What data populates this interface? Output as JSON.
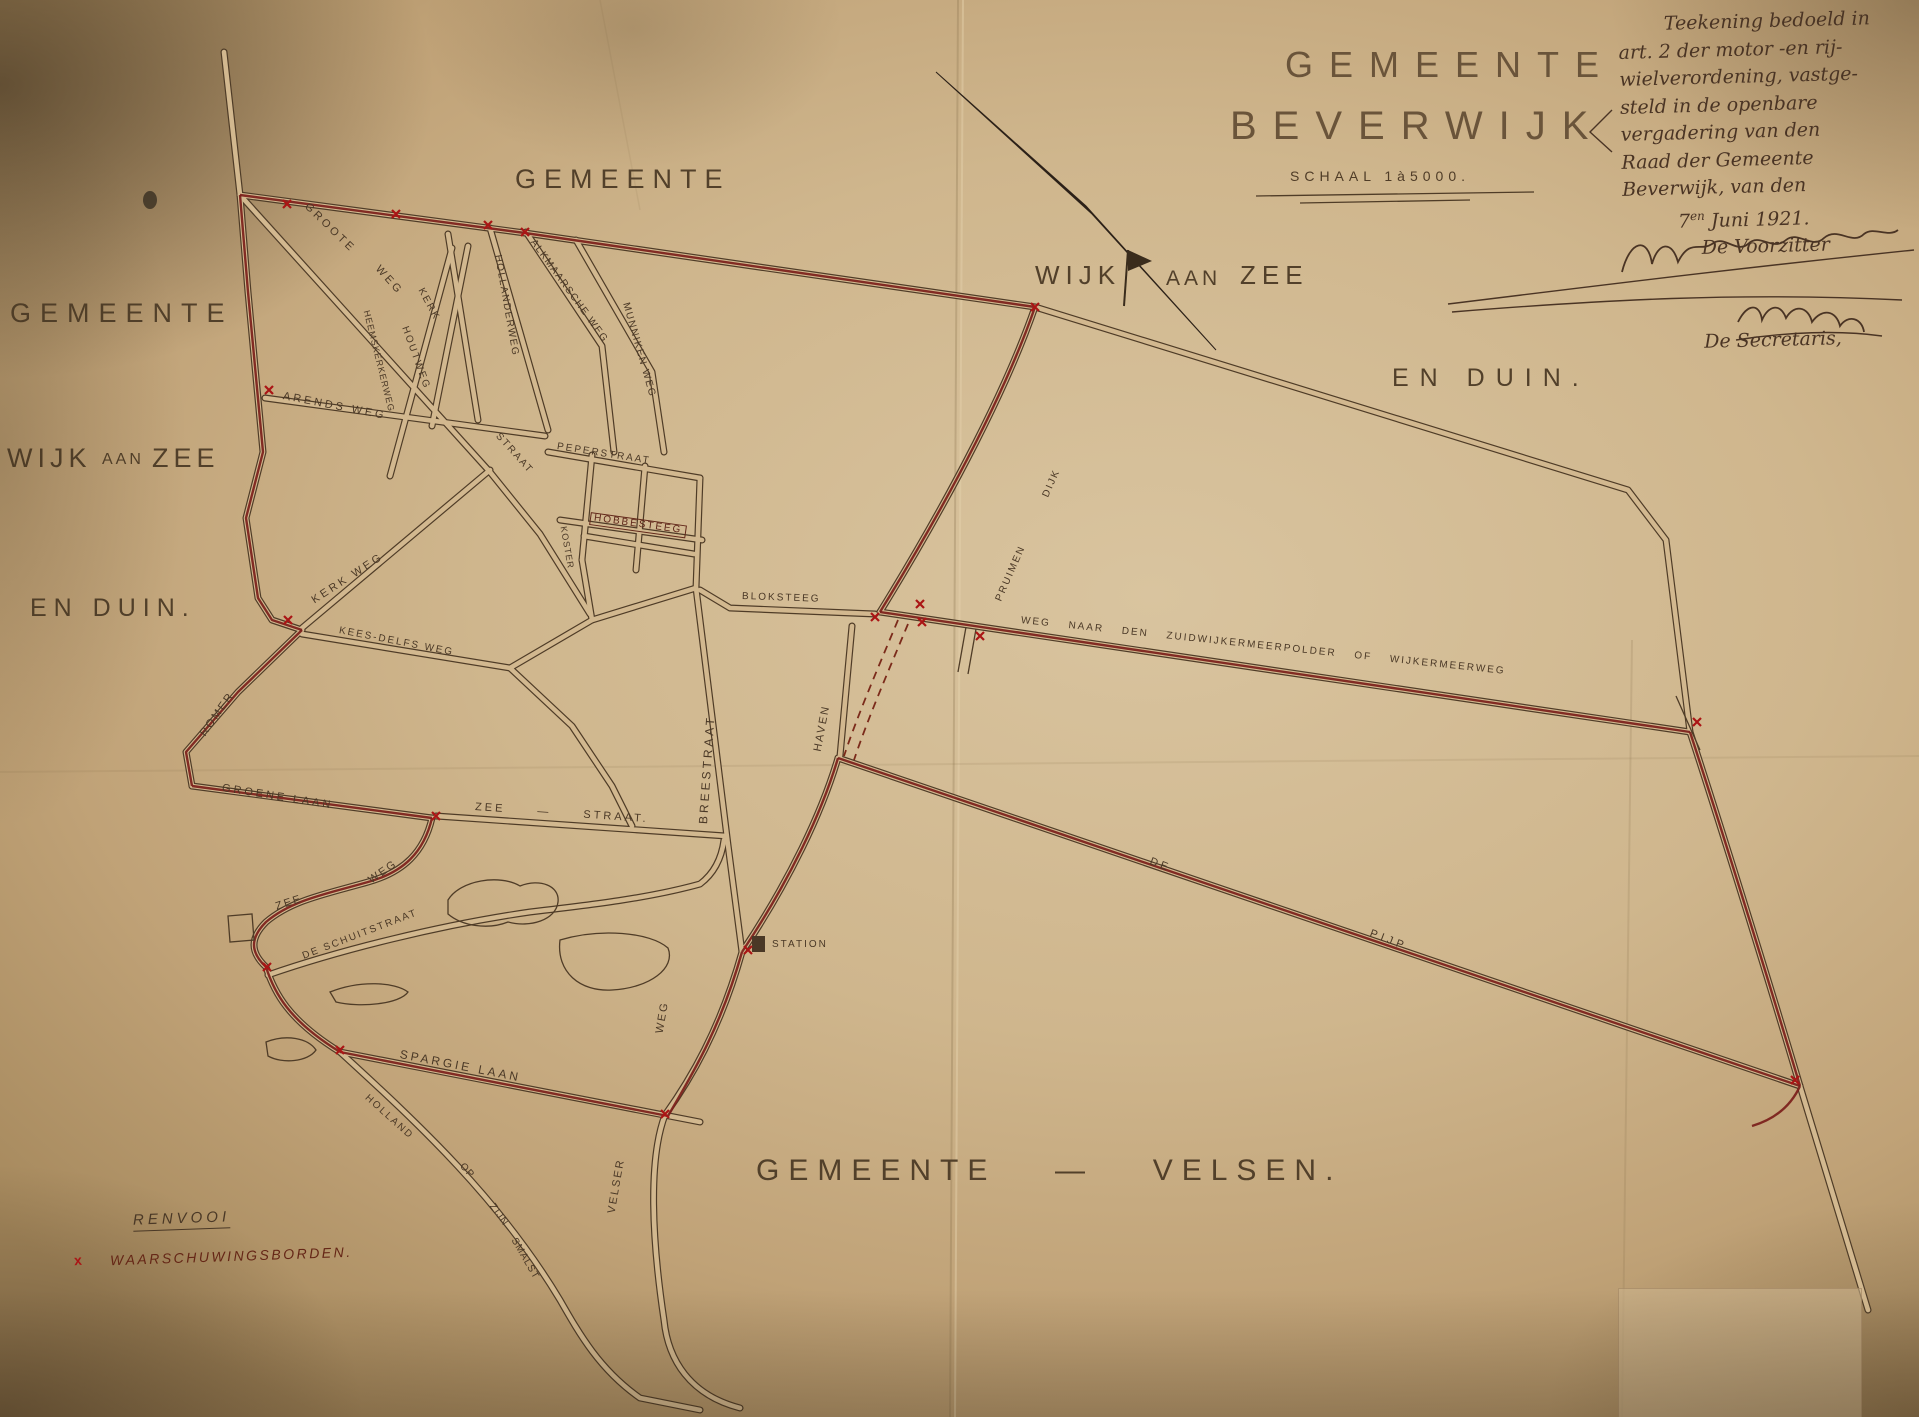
{
  "title_block": {
    "gemeente": "GEMEENTE",
    "beverwijk": "BEVERWIJK",
    "schaal": "SCHAAL 1à5000."
  },
  "note": {
    "lines": [
      "Teekening bedoeld in",
      "art. 2 der motor -en rij-",
      "wielverordening, vastge-",
      "steld in de openbare",
      "vergadering van den",
      "Raad der Gemeente",
      "Beverwijk, van den"
    ],
    "date_prefix": "7",
    "date_sup": "en",
    "date_rest": " Juni 1921.",
    "voorzitter": "De Voorzitter",
    "secretaris": "De Secretaris,"
  },
  "legend": {
    "title": "RENVOOI",
    "mark": "x",
    "label": "WAARSCHUWINGSBORDEN."
  },
  "colors": {
    "paper": "#d2b88f",
    "ink": "#4a3826",
    "boundary_red": "#7b1e1a",
    "mark_red": "#aa1515"
  },
  "labels": [
    {
      "id": "territory-gemeente-top",
      "t": "GEMEENTE",
      "x": 515,
      "y": 166,
      "s": 27,
      "r": 0,
      "ls": 8,
      "c": "#52402a"
    },
    {
      "id": "territory-gemeente-left",
      "t": "GEMEENTE",
      "x": 10,
      "y": 300,
      "s": 27,
      "r": 0,
      "ls": 9,
      "c": "#52402a"
    },
    {
      "id": "territory-wijk-left",
      "t": "WIJK",
      "x": 7,
      "y": 445,
      "s": 27,
      "r": 0,
      "ls": 5,
      "c": "#52402a"
    },
    {
      "id": "territory-aan-left",
      "t": "AAN",
      "x": 102,
      "y": 452,
      "s": 16,
      "r": 0,
      "ls": 3,
      "c": "#52402a"
    },
    {
      "id": "territory-zee-left",
      "t": "ZEE",
      "x": 152,
      "y": 445,
      "s": 27,
      "r": 0,
      "ls": 5,
      "c": "#52402a"
    },
    {
      "id": "territory-en-duin-left",
      "t": "EN DUIN.",
      "x": 30,
      "y": 596,
      "s": 25,
      "r": 0,
      "ls": 7,
      "c": "#52402a"
    },
    {
      "id": "territory-wijk-center",
      "t": "WIJK",
      "x": 1035,
      "y": 262,
      "s": 26,
      "r": 0,
      "ls": 6,
      "c": "#52402a"
    },
    {
      "id": "territory-aan-center",
      "t": "AAN",
      "x": 1166,
      "y": 268,
      "s": 21,
      "r": 0,
      "ls": 4,
      "c": "#52402a"
    },
    {
      "id": "territory-zee-center",
      "t": "ZEE",
      "x": 1240,
      "y": 262,
      "s": 26,
      "r": 0,
      "ls": 6,
      "c": "#52402a"
    },
    {
      "id": "territory-en-duin-right",
      "t": "EN DUIN.",
      "x": 1392,
      "y": 366,
      "s": 25,
      "r": 0,
      "ls": 11,
      "c": "#52402a"
    },
    {
      "id": "territory-gemeente-velsen",
      "t": "GEMEENTE  —  VELSEN.",
      "x": 756,
      "y": 1156,
      "s": 30,
      "r": 0,
      "ls": 9,
      "ws": 12,
      "c": "#52402a"
    },
    {
      "id": "street-groote",
      "t": "GROOTE",
      "x": 306,
      "y": 200,
      "s": 11,
      "r": 44,
      "ls": 3
    },
    {
      "id": "street-groote-weg",
      "t": "WEG",
      "x": 377,
      "y": 262,
      "s": 11,
      "r": 48,
      "ls": 3
    },
    {
      "id": "street-kerk",
      "t": "KERK",
      "x": 420,
      "y": 284,
      "s": 10,
      "r": 62,
      "ls": 2
    },
    {
      "id": "street-houtweg",
      "t": "HOUTWEG",
      "x": 404,
      "y": 322,
      "s": 10,
      "r": 70,
      "ls": 2
    },
    {
      "id": "street-heemskerkerweg",
      "t": "HEEMSKERKERWEG",
      "x": 366,
      "y": 306,
      "s": 9,
      "r": 76,
      "ls": 1
    },
    {
      "id": "street-hollanderweg",
      "t": "HOLLANDERWEG",
      "x": 497,
      "y": 250,
      "s": 10,
      "r": 80,
      "ls": 1.5
    },
    {
      "id": "street-alkmaarsche-weg",
      "t": "ALKMAARSCHE WEG",
      "x": 532,
      "y": 236,
      "s": 10,
      "r": 54,
      "ls": 1.5
    },
    {
      "id": "street-munniken-weg",
      "t": "MUNNIKEN WEG",
      "x": 625,
      "y": 298,
      "s": 10,
      "r": 74,
      "ls": 1.5
    },
    {
      "id": "street-arends-weg",
      "t": "ARENDS WEG",
      "x": 283,
      "y": 391,
      "s": 11,
      "r": 11,
      "ls": 3
    },
    {
      "id": "street-peperstraat",
      "t": "PEPERSTRAAT",
      "x": 557,
      "y": 442,
      "s": 10,
      "r": 9,
      "ls": 2
    },
    {
      "id": "street-hobbesteeg",
      "t": "HOBBESTEEG",
      "x": 590,
      "y": 512,
      "s": 10,
      "r": 8,
      "ls": 2,
      "c": "#5d2418",
      "box": true
    },
    {
      "id": "street-koster",
      "t": "KOSTER",
      "x": 563,
      "y": 522,
      "s": 9,
      "r": 80,
      "ls": 1
    },
    {
      "id": "street-straat",
      "t": "STRAAT",
      "x": 497,
      "y": 430,
      "s": 10,
      "r": 48,
      "ls": 2
    },
    {
      "id": "street-kerk-weg",
      "t": "KERK WEG",
      "x": 313,
      "y": 596,
      "s": 11,
      "r": -33,
      "ls": 3
    },
    {
      "id": "street-kees-delfs-weg",
      "t": "KEES-DELFS WEG",
      "x": 339,
      "y": 626,
      "s": 10,
      "r": 11,
      "ls": 2
    },
    {
      "id": "street-romer",
      "t": "ROMER",
      "x": 203,
      "y": 730,
      "s": 11,
      "r": -55,
      "ls": 2
    },
    {
      "id": "street-groene-laan",
      "t": "GROENE LAAN",
      "x": 222,
      "y": 783,
      "s": 11,
      "r": 9,
      "ls": 3
    },
    {
      "id": "street-zee-straat",
      "t": "ZEE  —  STRAAT.",
      "x": 475,
      "y": 802,
      "s": 11,
      "r": 4,
      "ls": 3,
      "ws": 10
    },
    {
      "id": "street-zee-weg-weg",
      "t": "WEG",
      "x": 370,
      "y": 876,
      "s": 11,
      "r": -35,
      "ls": 2
    },
    {
      "id": "street-zee-weg-zee",
      "t": "ZEE",
      "x": 276,
      "y": 902,
      "s": 11,
      "r": -18,
      "ls": 2
    },
    {
      "id": "street-de-schuitstraat",
      "t": "DE SCHUITSTRAAT",
      "x": 303,
      "y": 952,
      "s": 10,
      "r": -21,
      "ls": 2
    },
    {
      "id": "street-spargie-laan",
      "t": "SPARGIE LAAN",
      "x": 400,
      "y": 1048,
      "s": 12,
      "r": 11,
      "ls": 3
    },
    {
      "id": "street-holland",
      "t": "HOLLAND",
      "x": 366,
      "y": 1092,
      "s": 10,
      "r": 42,
      "ls": 2
    },
    {
      "id": "street-op",
      "t": "OP",
      "x": 461,
      "y": 1160,
      "s": 10,
      "r": 48,
      "ls": 1
    },
    {
      "id": "street-zijn",
      "t": "ZIJN",
      "x": 491,
      "y": 1200,
      "s": 10,
      "r": 54,
      "ls": 1
    },
    {
      "id": "street-smalst",
      "t": "SMALST",
      "x": 513,
      "y": 1234,
      "s": 10,
      "r": 60,
      "ls": 1
    },
    {
      "id": "street-velser",
      "t": "VELSER",
      "x": 612,
      "y": 1208,
      "s": 11,
      "r": -80,
      "ls": 2
    },
    {
      "id": "street-velser-weg",
      "t": "WEG",
      "x": 660,
      "y": 1028,
      "s": 11,
      "r": -80,
      "ls": 2
    },
    {
      "id": "street-breestraat",
      "t": "BREESTRAAT",
      "x": 703,
      "y": 818,
      "s": 12,
      "r": -86,
      "ls": 3
    },
    {
      "id": "street-haven",
      "t": "HAVEN",
      "x": 818,
      "y": 746,
      "s": 11,
      "r": -79,
      "ls": 2
    },
    {
      "id": "poi-station",
      "t": "STATION",
      "x": 772,
      "y": 940,
      "s": 10,
      "r": 0,
      "ls": 2
    },
    {
      "id": "street-bloksteeg",
      "t": "BLOKSTEEG",
      "x": 742,
      "y": 592,
      "s": 10,
      "r": 2,
      "ls": 2
    },
    {
      "id": "street-pruimen",
      "t": "PRUIMEN",
      "x": 999,
      "y": 596,
      "s": 10,
      "r": -66,
      "ls": 2
    },
    {
      "id": "street-dijk",
      "t": "DIJK",
      "x": 1046,
      "y": 492,
      "s": 10,
      "r": -66,
      "ls": 2
    },
    {
      "id": "street-zuidwijkermeerweg",
      "t": "WEG NAAR DEN ZUIDWIJKERMEERPOLDER OF WIJKERMEERWEG",
      "x": 1021,
      "y": 616,
      "s": 10,
      "r": 6,
      "ls": 2,
      "ws": 13
    },
    {
      "id": "street-de-pijp-de",
      "t": "DE",
      "x": 1150,
      "y": 856,
      "s": 11,
      "r": 21,
      "ls": 3
    },
    {
      "id": "street-de-pijp-pijp",
      "t": "PIJP",
      "x": 1370,
      "y": 928,
      "s": 11,
      "r": 21,
      "ls": 4
    }
  ],
  "warning_marks": [
    [
      287,
      204
    ],
    [
      396,
      214
    ],
    [
      488,
      225
    ],
    [
      525,
      232
    ],
    [
      269,
      390
    ],
    [
      288,
      620
    ],
    [
      436,
      816
    ],
    [
      267,
      967
    ],
    [
      340,
      1050
    ],
    [
      665,
      1114
    ],
    [
      748,
      950
    ],
    [
      875,
      617
    ],
    [
      920,
      604
    ],
    [
      922,
      622
    ],
    [
      980,
      636
    ],
    [
      1035,
      307
    ],
    [
      1697,
      722
    ],
    [
      1795,
      1080
    ]
  ]
}
